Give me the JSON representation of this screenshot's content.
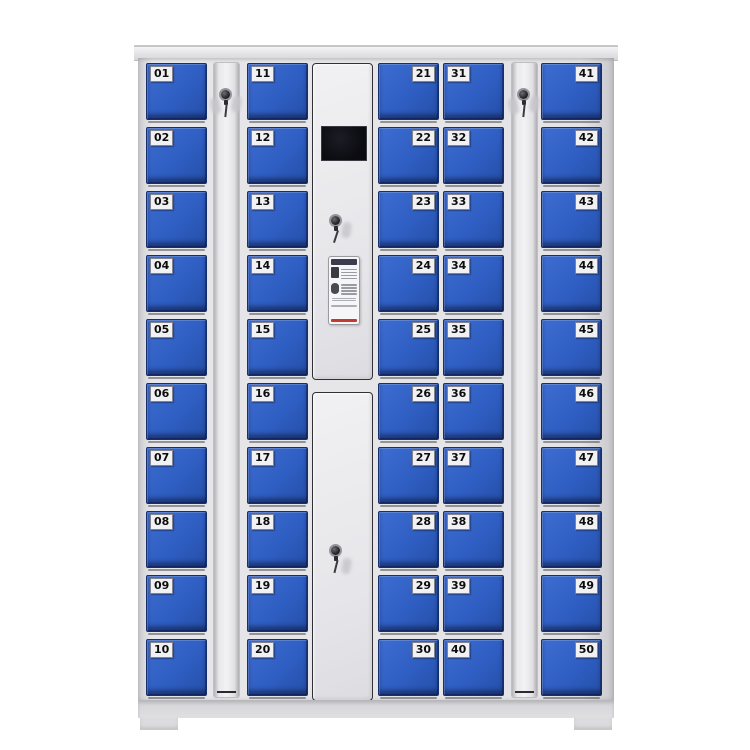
{
  "scene": {
    "type": "product-photo",
    "subject": "50-door smart storage locker cabinet with central control unit",
    "background": "#ffffff"
  },
  "theme": {
    "page-bg": "#ffffff",
    "door-blue": "#2f5ec2",
    "door-blue-light": "#3e6dd2",
    "door-border": "#16306e",
    "label-bg": "#f1f1f3",
    "label-text": "#0d0d0f",
    "screen-black": "#0b0b10",
    "sticker-bg": "#f6f6f8",
    "sticker-header": "#3c3c4c",
    "sticker-accent": "#c23a32",
    "lock-dark": "#1e1e24"
  },
  "cabinet": {
    "columns": {
      "c1": {
        "label_side": "left",
        "doors": [
          "01",
          "02",
          "03",
          "04",
          "05",
          "06",
          "07",
          "08",
          "09",
          "10"
        ]
      },
      "c2": {
        "label_side": "left",
        "doors": [
          "11",
          "12",
          "13",
          "14",
          "15",
          "16",
          "17",
          "18",
          "19",
          "20"
        ]
      },
      "c3": {
        "label_side": "right",
        "doors": [
          "21",
          "22",
          "23",
          "24",
          "25",
          "26",
          "27",
          "28",
          "29",
          "30"
        ]
      },
      "c4": {
        "label_side": "left",
        "doors": [
          "31",
          "32",
          "33",
          "34",
          "35",
          "36",
          "37",
          "38",
          "39",
          "40"
        ]
      },
      "c5": {
        "label_side": "right",
        "doors": [
          "41",
          "42",
          "43",
          "44",
          "45",
          "46",
          "47",
          "48",
          "49",
          "50"
        ]
      }
    },
    "lock_strips": [
      "left-key-strip",
      "right-key-strip"
    ],
    "control_unit": {
      "screen": "lcd-display",
      "sticker": "usage-instructions-card",
      "locks": [
        "control-top-door-lock",
        "control-bottom-door-lock"
      ]
    }
  }
}
